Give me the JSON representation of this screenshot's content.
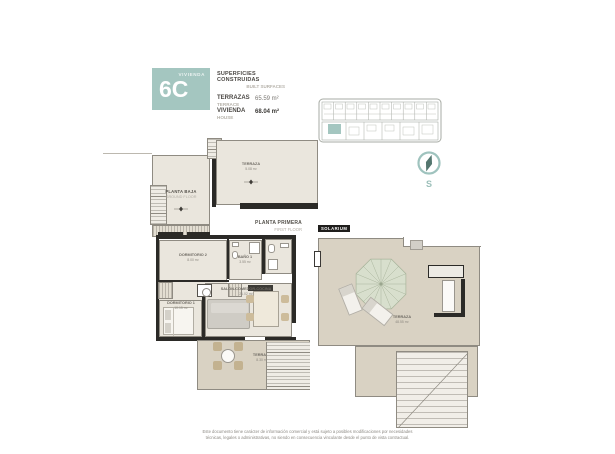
{
  "header": {
    "unit_label": "VIVIENDA",
    "unit_number": "6C",
    "surfaces_title_es": "SUPERFICIES CONSTRUIDAS",
    "surfaces_title_en": "BUILT SURFACES",
    "areas": [
      {
        "label_es": "TERRAZAS",
        "label_en": "TERRACE",
        "value": "65.59 m²"
      },
      {
        "label_es": "VIVIENDA",
        "label_en": "HOUSE",
        "value": "68.04 m²"
      }
    ]
  },
  "key_plan": {
    "description": "site key plan with unit highlighted",
    "highlight_color": "#a4c6c0"
  },
  "compass": {
    "south_label": "S"
  },
  "plans": {
    "planta_baja": {
      "title_es": "PLANTA BAJA",
      "title_en": "GROUND FLOOR",
      "rooms": [
        {
          "name": "TERRAZA",
          "area": "5.08 m²"
        }
      ]
    },
    "planta_primera": {
      "title_es": "PLANTA PRIMERA",
      "title_en": "FIRST FLOOR",
      "rooms": [
        {
          "name": "DORMITORIO 2",
          "area": "8.00 m²"
        },
        {
          "name": "BAÑO 1",
          "area": "3.55 m²"
        },
        {
          "name": "DORMITORIO 1",
          "area": "10.15 m²"
        },
        {
          "name": "SALÓN-COMEDOR-COCINA",
          "area": "21.02 m²"
        },
        {
          "name": "TERRAZA",
          "area": "8.30 m²"
        }
      ]
    },
    "solarium": {
      "title": "SOLARIUM",
      "rooms": [
        {
          "name": "TERRAZA",
          "area": "48.55 m²"
        }
      ]
    }
  },
  "footer": {
    "line1": "Este documento tiene carácter de información comercial y está sujeto a posibles modificaciones por necesidades",
    "line2": "técnicas, legales o administrativas, no siendo en consecuencia vinculante desde el punto de vista contractual."
  },
  "colors": {
    "accent_teal": "#a4c6c0",
    "floor_fill": "#eae6dd",
    "terrace_fill": "#d9d2c3",
    "wall": "#2b2a27"
  }
}
